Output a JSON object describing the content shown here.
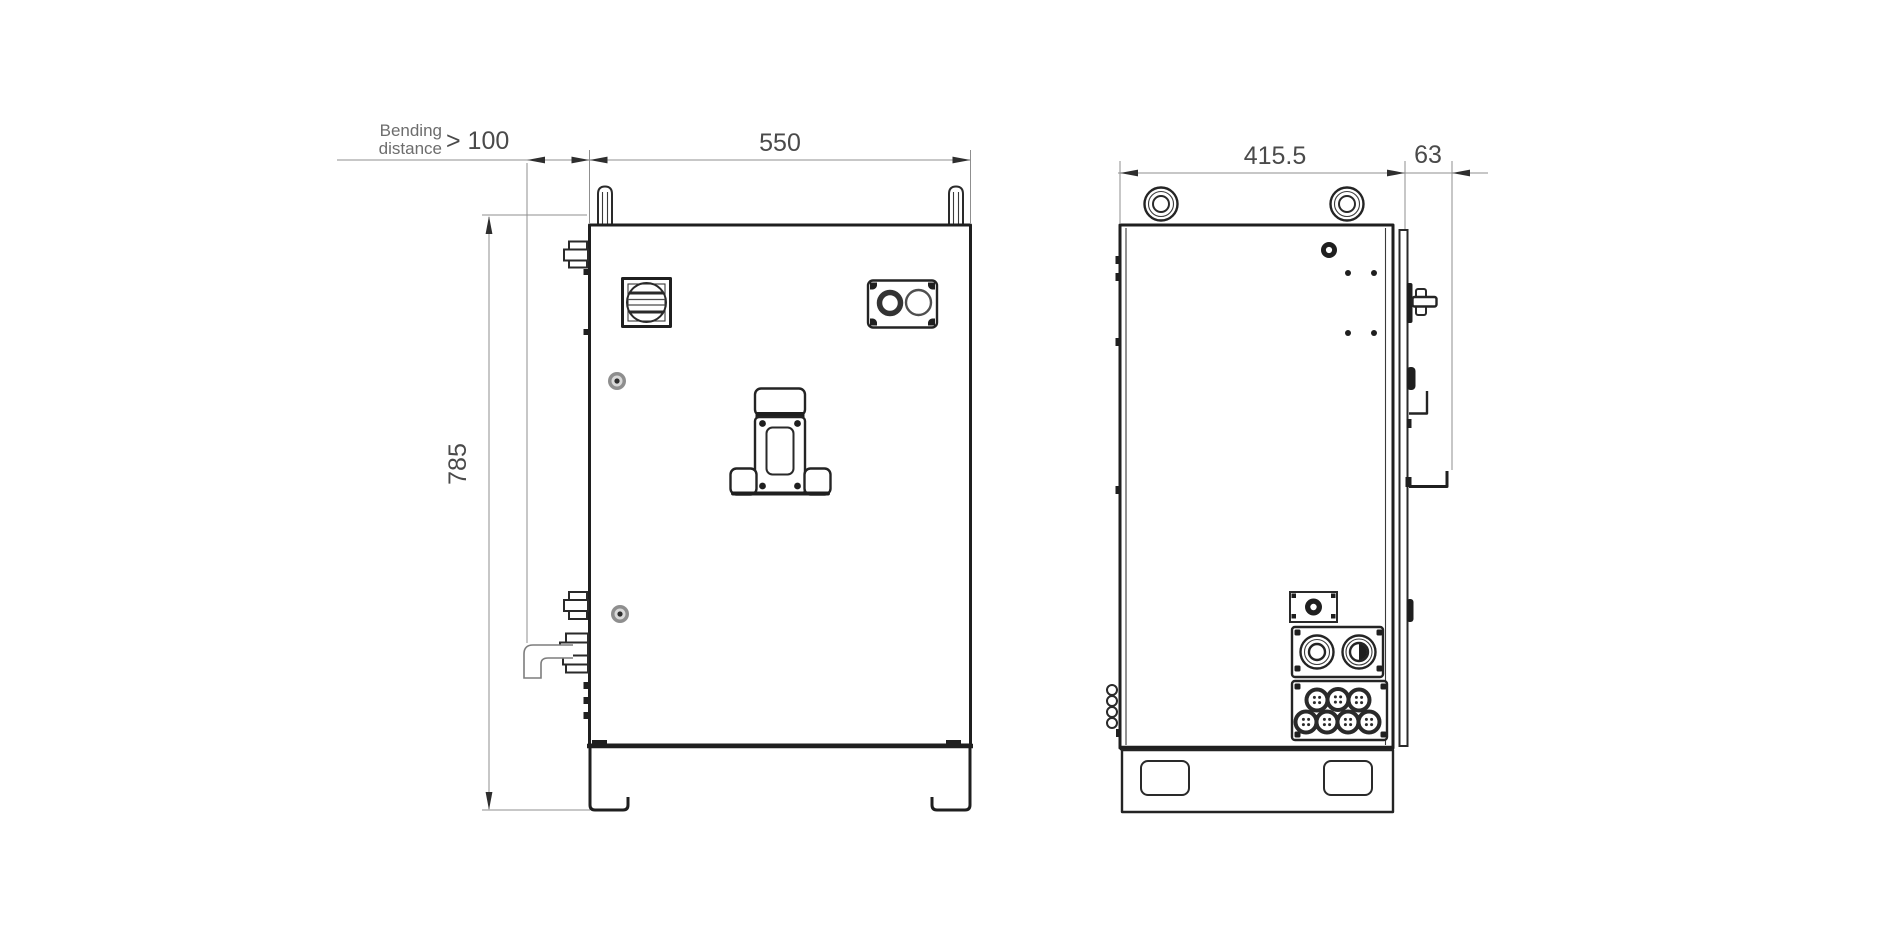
{
  "annotations": {
    "bending_note_line1": "Bending",
    "bending_note_line2": "distance",
    "bending_value": "> 100",
    "front_width": "550",
    "front_height": "785",
    "side_depth": "415.5",
    "side_protrusion": "63"
  },
  "colors": {
    "outline": "#1f1f1f",
    "dimension_line": "#8f8f8f",
    "dimension_text": "#4a4a4a",
    "note_text": "#6d6d6d",
    "background": "#ffffff"
  }
}
